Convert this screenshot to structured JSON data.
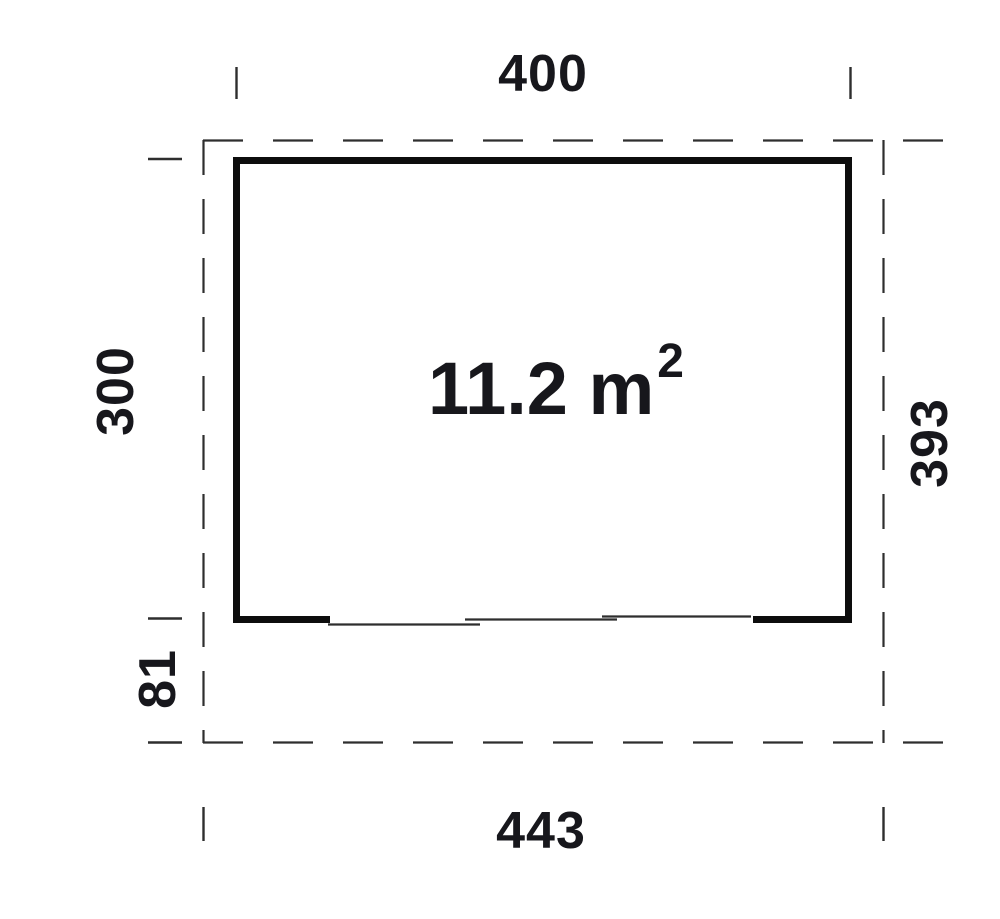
{
  "drawing": {
    "type": "floor-plan",
    "area_label": {
      "base": "11.2 m",
      "exponent": "2"
    },
    "dimensions": {
      "width_top": "400",
      "height_left": "300",
      "height_right": "393",
      "overhang_bottom_left": "81",
      "width_bottom": "443"
    },
    "colors": {
      "wall": "#0d0d0d",
      "line": "#2e2e2e",
      "text": "#17171c",
      "background": "#ffffff"
    }
  }
}
